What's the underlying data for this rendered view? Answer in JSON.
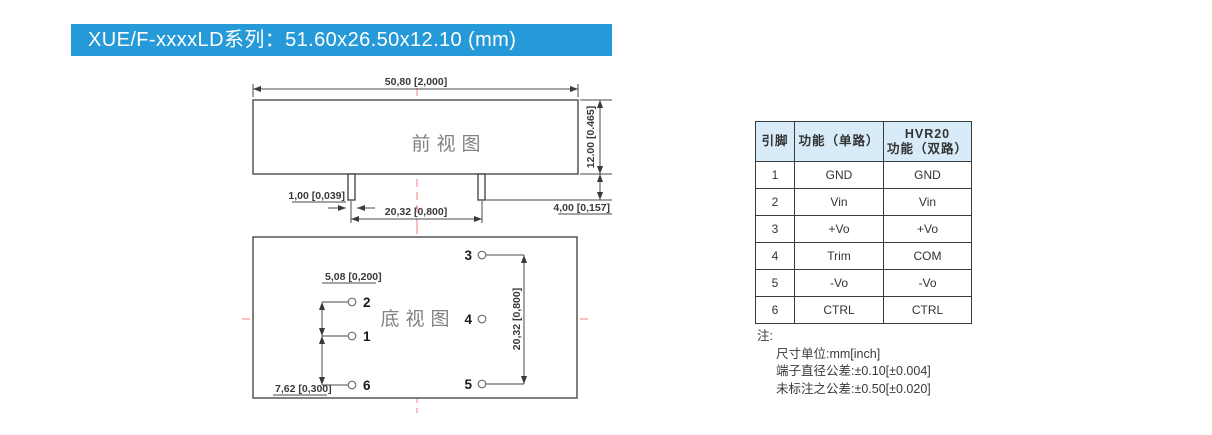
{
  "banner": {
    "title": "XUE/F-xxxxLD系列：51.60x26.50x12.10 (mm)"
  },
  "front_view": {
    "label": "前视图",
    "dim_width": "50,80 [2,000]",
    "dim_height": "12.00 [0.465]",
    "dim_pin_width": "1,00 [0,039]",
    "dim_pin_pitch": "20,32 [0,800]",
    "dim_pin_length": "4,00 [0,157]"
  },
  "bottom_view": {
    "label": "底视图",
    "dim_pitch_2_1": "5,08 [0,200]",
    "dim_pitch_1_6": "7,62 [0,300]",
    "dim_pitch_3_5": "20,32 [0,800]",
    "pin_labels": {
      "p1": "1",
      "p2": "2",
      "p3": "3",
      "p4": "4",
      "p5": "5",
      "p6": "6"
    }
  },
  "pin_table": {
    "col_pin": "引脚",
    "col_single": "功能（单路）",
    "col_dual_line1": "HVR20",
    "col_dual_line2": "功能（双路）",
    "rows": [
      {
        "pin": "1",
        "single": "GND",
        "dual": "GND"
      },
      {
        "pin": "2",
        "single": "Vin",
        "dual": "Vin"
      },
      {
        "pin": "3",
        "single": "+Vo",
        "dual": "+Vo"
      },
      {
        "pin": "4",
        "single": "Trim",
        "dual": "COM"
      },
      {
        "pin": "5",
        "single": "-Vo",
        "dual": "-Vo"
      },
      {
        "pin": "6",
        "single": "CTRL",
        "dual": "CTRL"
      }
    ]
  },
  "notes": {
    "title": "注:",
    "line1": "尺寸单位:mm[inch]",
    "line2": "端子直径公差:±0.10[±0.004]",
    "line3": "未标注之公差:±0.50[±0.020]"
  },
  "colors": {
    "banner_bg": "#2699D8",
    "table_header_bg": "#D7ECF8",
    "centerline_red": "#F28080",
    "drawing_line": "#3C3C3C"
  }
}
